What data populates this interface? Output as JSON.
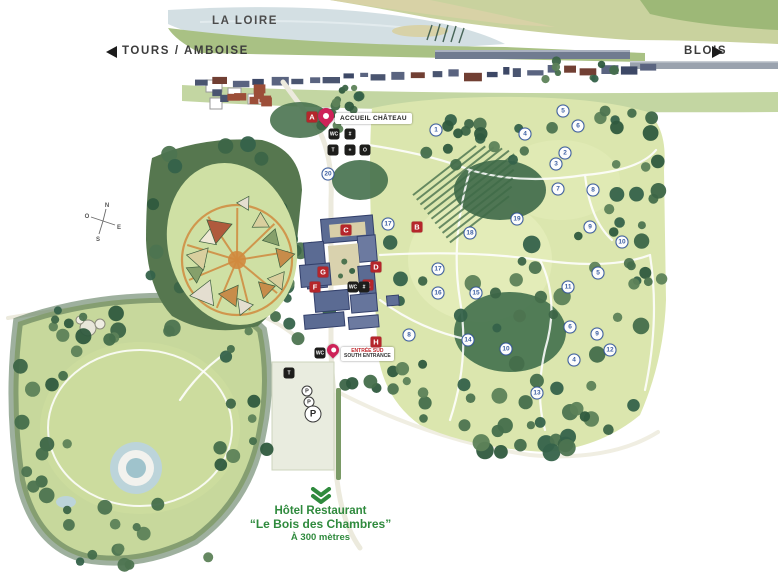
{
  "nav": {
    "river": "LA LOIRE",
    "west": "TOURS / AMBOISE",
    "east": "BLOIS"
  },
  "accueil": {
    "label": "ACCUEIL CHÂTEAU"
  },
  "south_entrance": {
    "line1": "ENTRÉE SUD",
    "line2": "SOUTH ENTRANCE"
  },
  "footer": {
    "line1": "Hôtel Restaurant",
    "line2": "“Le Bois des Chambres”",
    "line3": "À 300 mètres"
  },
  "compass": {
    "n": "N",
    "e": "E",
    "s": "S",
    "o": "O"
  },
  "letter_markers": [
    {
      "id": "A",
      "x": 312,
      "y": 117
    },
    {
      "id": "B",
      "x": 417,
      "y": 227
    },
    {
      "id": "C",
      "x": 346,
      "y": 230
    },
    {
      "id": "D",
      "x": 376,
      "y": 267
    },
    {
      "id": "G",
      "x": 323,
      "y": 272
    },
    {
      "id": "F",
      "x": 315,
      "y": 287
    },
    {
      "id": "E",
      "x": 368,
      "y": 285
    },
    {
      "id": "H",
      "x": 376,
      "y": 342
    }
  ],
  "number_markers": [
    {
      "n": "20",
      "x": 328,
      "y": 174
    },
    {
      "n": "1",
      "x": 436,
      "y": 130
    },
    {
      "n": "4",
      "x": 525,
      "y": 134
    },
    {
      "n": "5",
      "x": 563,
      "y": 111
    },
    {
      "n": "6",
      "x": 578,
      "y": 126
    },
    {
      "n": "2",
      "x": 565,
      "y": 153
    },
    {
      "n": "3",
      "x": 556,
      "y": 164
    },
    {
      "n": "7",
      "x": 558,
      "y": 189
    },
    {
      "n": "8",
      "x": 593,
      "y": 190
    },
    {
      "n": "19",
      "x": 517,
      "y": 219
    },
    {
      "n": "9",
      "x": 590,
      "y": 227
    },
    {
      "n": "18",
      "x": 470,
      "y": 233
    },
    {
      "n": "10",
      "x": 622,
      "y": 242
    },
    {
      "n": "17",
      "x": 388,
      "y": 224
    },
    {
      "n": "17",
      "x": 438,
      "y": 269
    },
    {
      "n": "16",
      "x": 438,
      "y": 293
    },
    {
      "n": "15",
      "x": 476,
      "y": 293
    },
    {
      "n": "11",
      "x": 568,
      "y": 287
    },
    {
      "n": "5",
      "x": 598,
      "y": 273
    },
    {
      "n": "14",
      "x": 468,
      "y": 340
    },
    {
      "n": "8",
      "x": 409,
      "y": 335
    },
    {
      "n": "10",
      "x": 506,
      "y": 349
    },
    {
      "n": "6",
      "x": 570,
      "y": 327
    },
    {
      "n": "9",
      "x": 597,
      "y": 334
    },
    {
      "n": "12",
      "x": 610,
      "y": 350
    },
    {
      "n": "4",
      "x": 574,
      "y": 360
    },
    {
      "n": "13",
      "x": 537,
      "y": 393
    }
  ],
  "facility_icons": [
    {
      "name": "toilets-icon",
      "glyph": "WC",
      "x": 334,
      "y": 134
    },
    {
      "name": "tickets-icon",
      "glyph": "#",
      "x": 350,
      "y": 134
    },
    {
      "name": "picnic-icon",
      "glyph": "T",
      "x": 333,
      "y": 150
    },
    {
      "name": "first-aid-icon",
      "glyph": "+",
      "x": 350,
      "y": 150
    },
    {
      "name": "photo-icon",
      "glyph": "O",
      "x": 365,
      "y": 150
    },
    {
      "name": "toilets-icon",
      "glyph": "WC",
      "x": 353,
      "y": 287
    },
    {
      "name": "cloakroom-icon",
      "glyph": "#",
      "x": 364,
      "y": 287
    },
    {
      "name": "toilets-icon",
      "glyph": "WC",
      "x": 320,
      "y": 353
    },
    {
      "name": "picnic-icon",
      "glyph": "T",
      "x": 289,
      "y": 373
    }
  ],
  "parking_markers": [
    {
      "label": "P",
      "x": 307,
      "y": 391,
      "size": "small"
    },
    {
      "label": "P",
      "x": 309,
      "y": 402,
      "size": "small"
    },
    {
      "label": "P",
      "x": 313,
      "y": 414,
      "size": "large"
    }
  ],
  "colors": {
    "letter_marker_red": "#b5262b",
    "number_marker_blue": "#3c5fa3",
    "pin_pink": "#ce2258",
    "footer_green": "#2f8a3d",
    "park_green": "#dbe6ae",
    "forest_green": "#4d7450",
    "river_blue": "#d3dfe3",
    "village_slate": "#4a5570",
    "path_orange": "#d08a3e"
  }
}
